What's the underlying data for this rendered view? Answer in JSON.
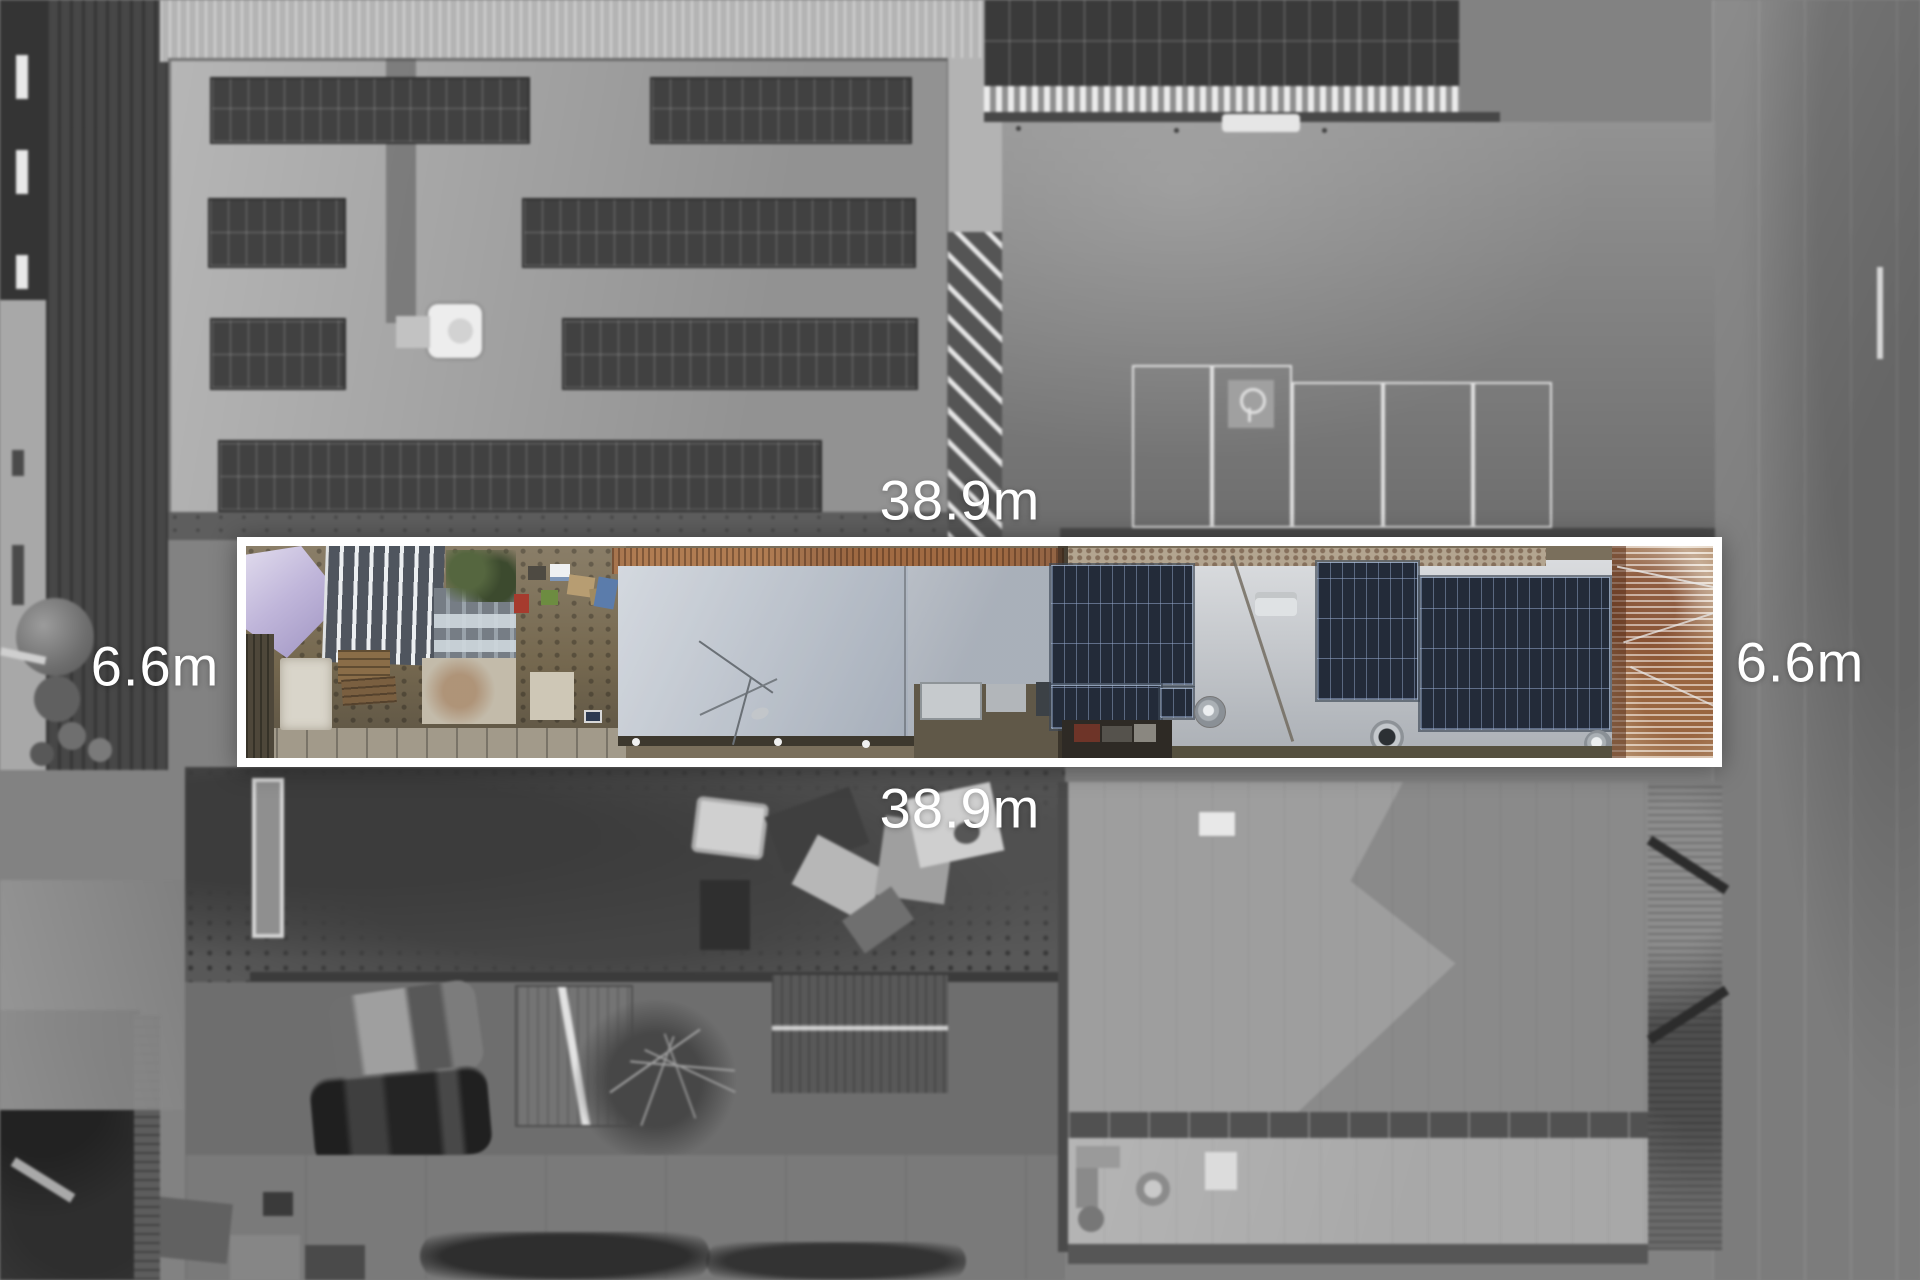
{
  "annotations": {
    "top_width": "38.9m",
    "bottom_width": "38.9m",
    "left_depth": "6.6m",
    "right_depth": "6.6m"
  },
  "colors": {
    "boundary_white": "#ffffff",
    "label_text": "#ffffff",
    "solar_panel_navy": "#232b39",
    "tarp_lavender": "#c0b6da",
    "rust_roof": "#8f6245",
    "silver_roof": "#c9ccd0",
    "background_gray": "#828282"
  }
}
